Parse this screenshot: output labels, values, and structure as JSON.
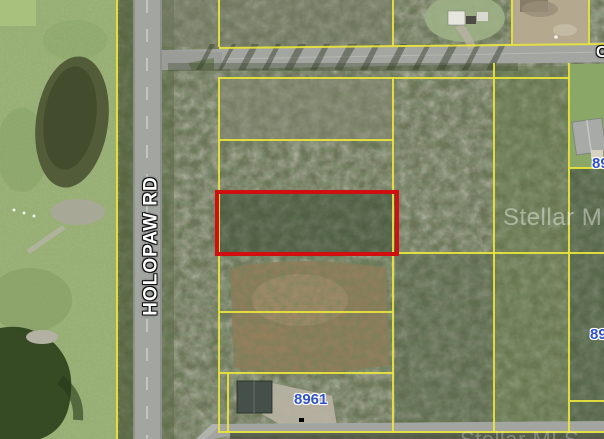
{
  "map": {
    "road_labels": {
      "vertical_road": "HOLOPAW RD",
      "cross_road_partial": "C"
    },
    "address_labels": {
      "main": "8961",
      "right_edge_upper": "89",
      "right_edge_lower": "89"
    },
    "watermarks": [
      {
        "text": "Stellar MLS"
      },
      {
        "text": "Stellar MLS"
      }
    ],
    "highlight_parcel": {
      "description": "red-outlined subject parcel"
    },
    "colors": {
      "parcel_line": "#e9e43c",
      "highlight_red": "#d01010",
      "address_blue": "#2f52c8",
      "label_white": "#ffffff",
      "road_gray": "#a3a6a0",
      "field_green": "#97ae74",
      "woods_green": "#6d7459"
    }
  }
}
